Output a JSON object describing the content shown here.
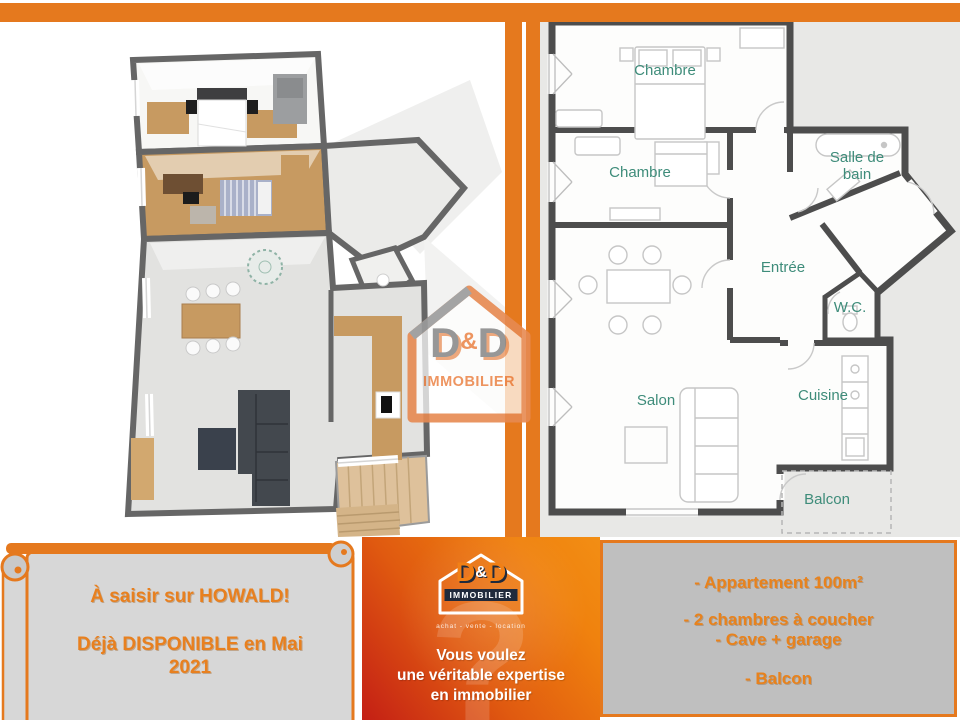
{
  "colors": {
    "frame_orange": "#E5791E",
    "accent_orange_text": "#E8821C",
    "gradient_red": "#C41F15",
    "gradient_orange": "#F0820E",
    "navy": "#202A3C",
    "room_label_teal": "#3E8C7A",
    "wall_gray": "#4D4D4D",
    "box_gray": "#BFBFBF"
  },
  "left_panel": {
    "watermark": {
      "d1": "D",
      "amp": "&",
      "d2": "D",
      "sub": "IMMOBILIER"
    }
  },
  "right_plan": {
    "labels": {
      "chambre_top": "Chambre",
      "chambre_mid": "Chambre",
      "salle_de_bain_line1": "Salle de",
      "salle_de_bain_line2": "bain",
      "entree": "Entrée",
      "wc": "W.C.",
      "salon": "Salon",
      "cuisine": "Cuisine",
      "balcon": "Balcon"
    }
  },
  "banner": {
    "line1": "À saisir sur HOWALD!",
    "line2": "Déjà DISPONIBLE en Mai",
    "line3": "2021"
  },
  "agency": {
    "logo": {
      "d1": "D",
      "amp": "&",
      "d2": "D",
      "sub": "IMMOBILIER",
      "tagline": "achat - vente - location"
    },
    "question_mark": "?",
    "pitch_line1": "Vous voulez",
    "pitch_line2": "une véritable expertise",
    "pitch_line3": "en immobilier",
    "contact": "contact@ddimmo.lu",
    "website": "www.ddimmo.lu"
  },
  "details": {
    "line1": "- Appartement 100m²",
    "line2": "- 2 chambres à coucher",
    "line3": "-  Cave + garage",
    "line4": "- Balcon"
  }
}
